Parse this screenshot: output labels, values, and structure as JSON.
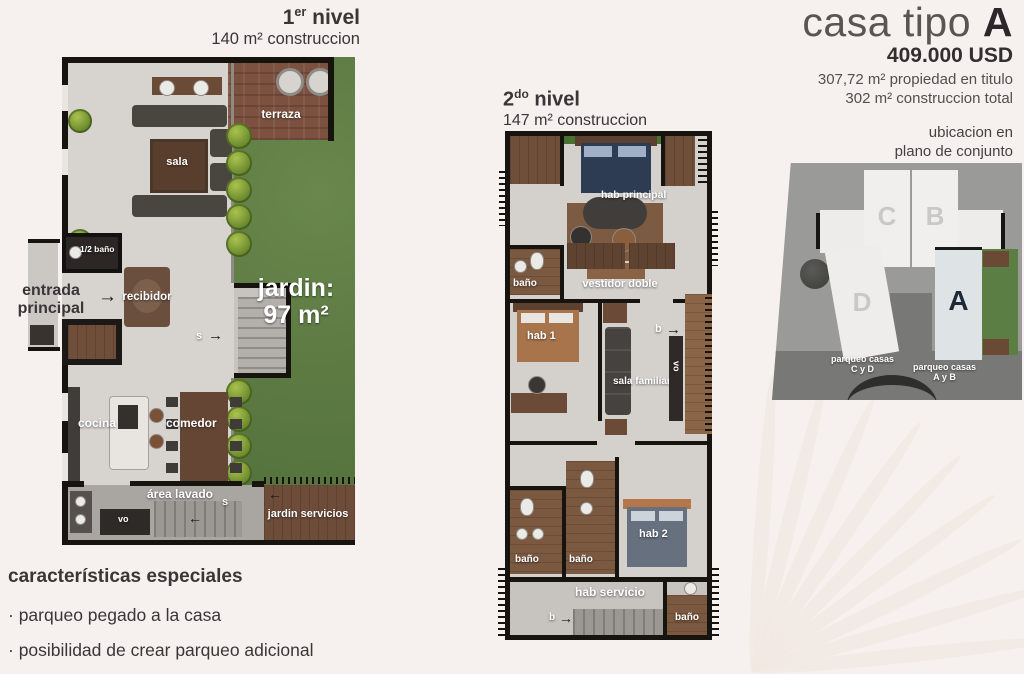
{
  "header": {
    "title_prefix": "casa tipo ",
    "title_letter": "A",
    "price": "409.000 USD",
    "line1": "307,72 m² propiedad en titulo",
    "line2": "302 m² construccion total"
  },
  "level1": {
    "title_num": "1",
    "title_sup": "er",
    "title_rest": " nivel",
    "subtitle": "140 m² construccion",
    "labels": {
      "terraza": "terraza",
      "sala": "sala",
      "half_bath": "1/2 baño",
      "entrada_l1": "entrada",
      "entrada_l2": "principal",
      "recibidor": "recibidor",
      "jardin_l1": "jardin:",
      "jardin_l2": "97 m²",
      "stairs_s": "s",
      "cocina": "cocina",
      "comedor": "comedor",
      "area_lavado": "área lavado",
      "lavado_s": "s",
      "vo": "vo",
      "jardin_servicios": "jardin servicios"
    }
  },
  "level2": {
    "title_num": "2",
    "title_sup": "do",
    "title_rest": " nivel",
    "subtitle": "147 m² construccion",
    "labels": {
      "hab_principal": "hab principal",
      "bano_principal": "baño",
      "vestidor": "vestidor doble",
      "hab1": "hab 1",
      "sala_familiar": "sala familiar",
      "balcon_b": "b",
      "vo": "vo",
      "bano_1": "baño",
      "bano_2": "baño",
      "hab2": "hab 2",
      "hab_servicio": "hab servicio",
      "servicio_b": "b",
      "bano_servicio": "baño"
    }
  },
  "siteplan": {
    "caption_l1": "ubicacion en",
    "caption_l2": "plano de conjunto",
    "house_c": "C",
    "house_b": "B",
    "house_d": "D",
    "house_a": "A",
    "parqueo_cd_l1": "parqueo casas",
    "parqueo_cd_l2": "C y D",
    "parqueo_ab_l1": "parqueo casas",
    "parqueo_ab_l2": "A y B"
  },
  "features": {
    "heading": "características especiales",
    "items": [
      {
        "bullet": "·",
        "text": "parqueo pegado a la casa"
      },
      {
        "bullet": "·",
        "text": "posibilidad de crear parqueo adicional"
      }
    ]
  },
  "icons": {
    "arrow_right": "→",
    "arrow_left": "←"
  }
}
